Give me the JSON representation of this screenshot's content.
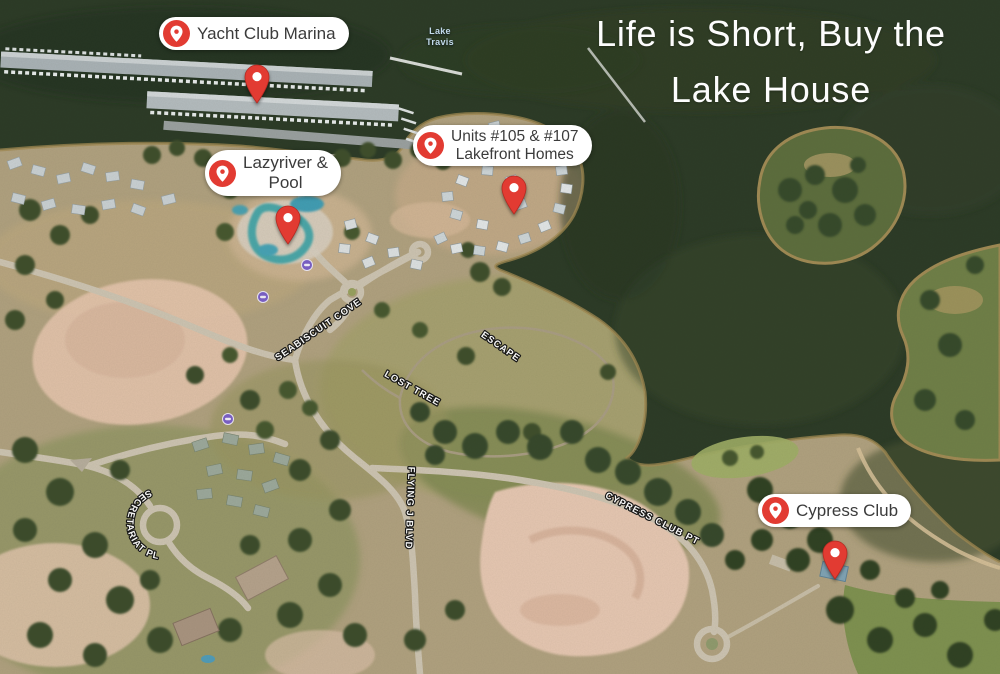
{
  "headline": {
    "line1": "Life is Short, Buy the",
    "line2": "Lake House"
  },
  "lake_label": {
    "line1": "Lake",
    "line2": "Travis"
  },
  "callouts": {
    "yacht": {
      "line1": "Yacht Club Marina"
    },
    "lazyriver": {
      "line1": "Lazyriver &",
      "line2": "Pool"
    },
    "units": {
      "line1": "Units #105 & #107",
      "line2": "Lakefront Homes"
    },
    "cypress": {
      "line1": "Cypress Club"
    }
  },
  "streets": {
    "seabiscuit": "SEABISCUIT COVE",
    "escape": "ESCAPE",
    "lost_tree": "LOST TREE",
    "flying_j": "FLYING J BLVD",
    "cypress_club_pt": "CYPRESS CLUB PT",
    "secretariat": "SECRETARIAT PL"
  },
  "colors": {
    "pin_red": "#E23B32",
    "water_dark": "#2B3A26",
    "land_tan": "#B0A17F",
    "dirt_pink": "#E6C7B2",
    "road": "#CDC4B2",
    "street_text": "#FFFFFF",
    "label_text": "#3B3B3B",
    "lake_label_text": "#C2DAEB",
    "poi_purple": "#7A5FC7"
  }
}
